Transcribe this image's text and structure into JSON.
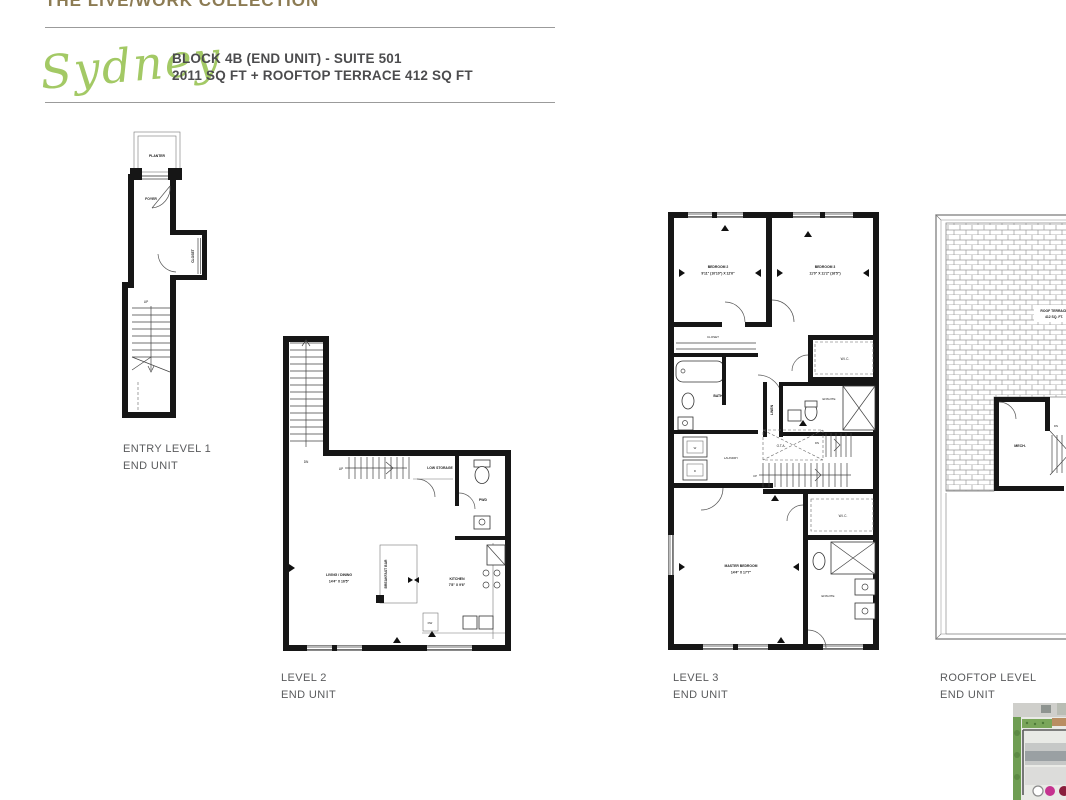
{
  "header": {
    "collection": "THE LIVE/WORK COLLECTION",
    "model_name": "Sydney",
    "block_line": "BLOCK 4B (END UNIT) - SUITE 501",
    "sqft_line": "2011 SQ FT + ROOFTOP TERRACE 412 SQ FT"
  },
  "colors": {
    "collection_text": "#8c7b53",
    "script_green": "#a3c965",
    "heading_text": "#4c4c4e",
    "caption_text": "#5a5b5d",
    "wall_black": "#161616",
    "thumb_green": "#6f9e53",
    "thumb_magenta": "#c5338f",
    "thumb_maroon": "#8a1e3c"
  },
  "plans": {
    "entry": {
      "caption_line1": "ENTRY LEVEL 1",
      "caption_line2": "END UNIT",
      "rooms": {
        "planter": "PLANTER",
        "foyer": "FOYER",
        "closet": "CLOSET",
        "up": "UP"
      }
    },
    "level2": {
      "caption_line1": "LEVEL 2",
      "caption_line2": "END UNIT",
      "rooms": {
        "dn": "DN",
        "up": "UP",
        "low_storage": "LOW STORAGE",
        "pwd": "PWD",
        "breakfast_bar": "BREAKFAST BAR",
        "living_dining": "LIVING / DINING",
        "living_dining_dims": "14'4\" X 16'5\"",
        "kitchen": "KITCHEN",
        "kitchen_dims": "7'8\" X 9'6\"",
        "dw": "DW"
      }
    },
    "level3": {
      "caption_line1": "LEVEL 3",
      "caption_line2": "END UNIT",
      "rooms": {
        "bedroom2": "BEDROOM 2",
        "bedroom2_dims": "9'11\" (10'10\") X 12'6\"",
        "bedroom3": "BEDROOM 3",
        "bedroom3_dims": "11'0\" X 11'2\" (16'5\")",
        "closet": "CLOSET",
        "bath": "BATH",
        "wic_upper": "W.I.C.",
        "linen": "LINEN",
        "ensuite_upper": "ENSUITE",
        "laundry": "LAUNDRY",
        "washer": "W",
        "dryer": "D",
        "ota": "O.T.A.",
        "up": "UP",
        "dn": "DN",
        "wic_master": "W.I.C.",
        "master": "MASTER BEDROOM",
        "master_dims": "14'4\" X 17'7\"",
        "ensuite_master": "ENSUITE"
      }
    },
    "rooftop": {
      "caption_line1": "ROOFTOP LEVEL",
      "caption_line2": "END UNIT",
      "rooms": {
        "roof_terrace": "ROOF TERRACE",
        "roof_terrace_sqft": "412 SQ. FT.",
        "mech": "MECH.",
        "dn": "DN"
      }
    }
  }
}
